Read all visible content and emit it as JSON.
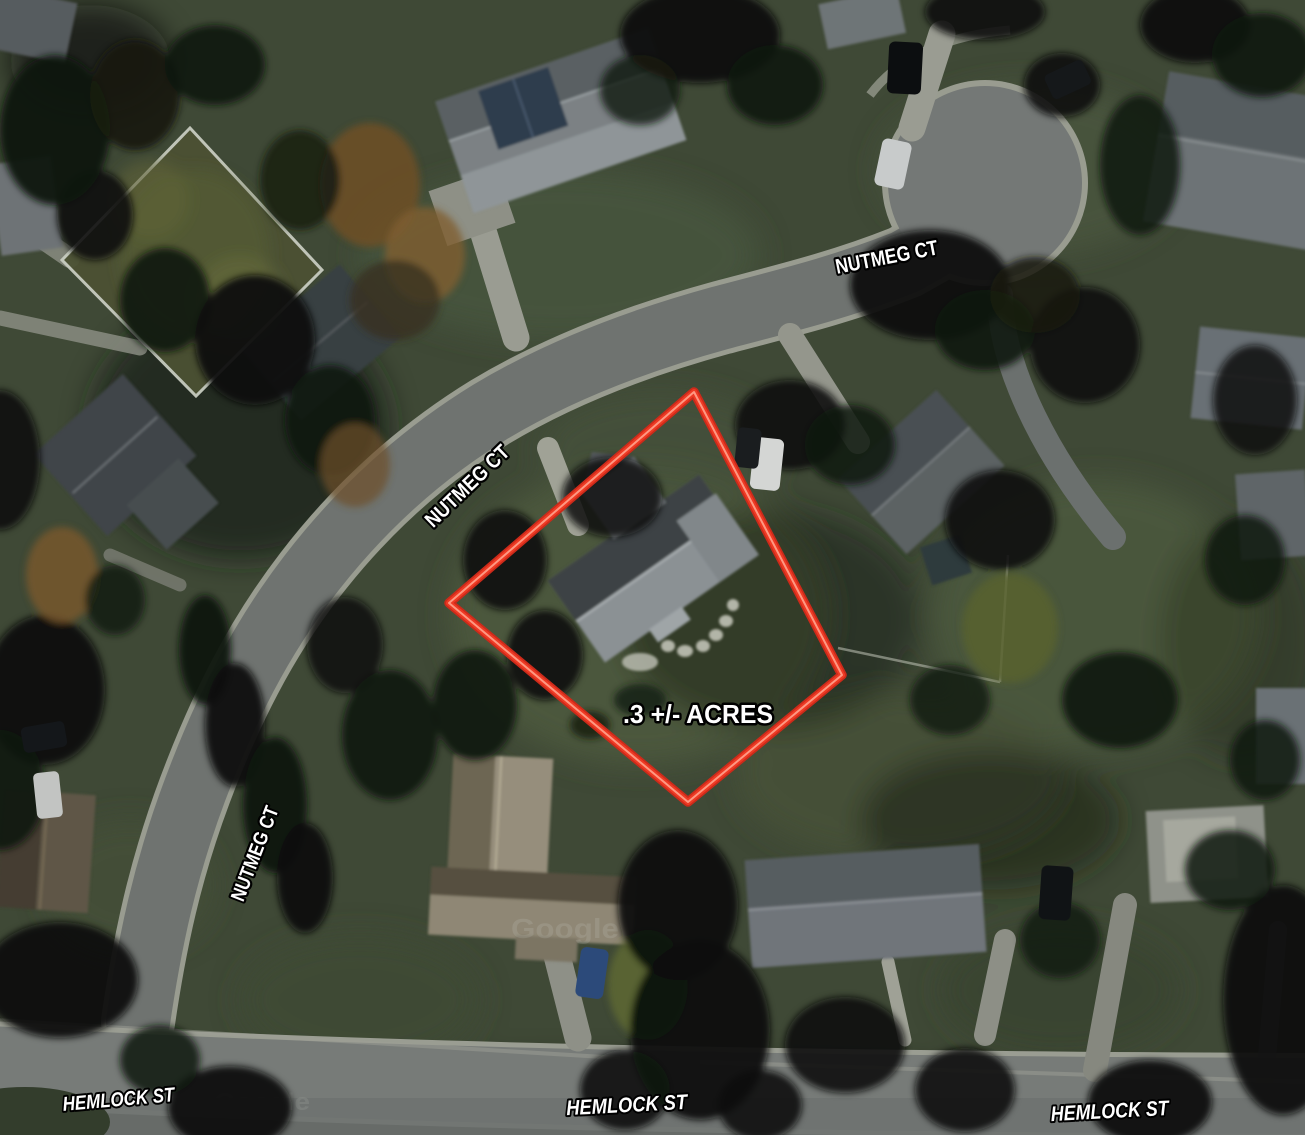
{
  "map": {
    "description": "Aerial satellite view of a residential cul-de-sac neighborhood with a red outlined lot",
    "street_labels": [
      {
        "id": "nutmeg-ct-top",
        "text": "NUTMEG CT"
      },
      {
        "id": "nutmeg-ct-middle",
        "text": "NUTMEG CT"
      },
      {
        "id": "nutmeg-ct-lower",
        "text": "NUTMEG CT"
      },
      {
        "id": "hemlock-st-left",
        "text": "HEMLOCK ST"
      },
      {
        "id": "hemlock-st-center",
        "text": "HEMLOCK ST"
      },
      {
        "id": "hemlock-st-right",
        "text": "HEMLOCK ST"
      }
    ],
    "lot": {
      "acreage_label": ".3 +/- ACRES",
      "outline_points": "694,392 842,675 688,802 449,603",
      "outline_color": "#ee3a24"
    },
    "watermark_text": "Google",
    "colors": {
      "label_text": "#ffffff",
      "label_outline": "#000000",
      "lot_outline": "#ee3a24",
      "road": "#6f7370",
      "lawn": "#3f4936",
      "tree": "#0e130e"
    }
  }
}
